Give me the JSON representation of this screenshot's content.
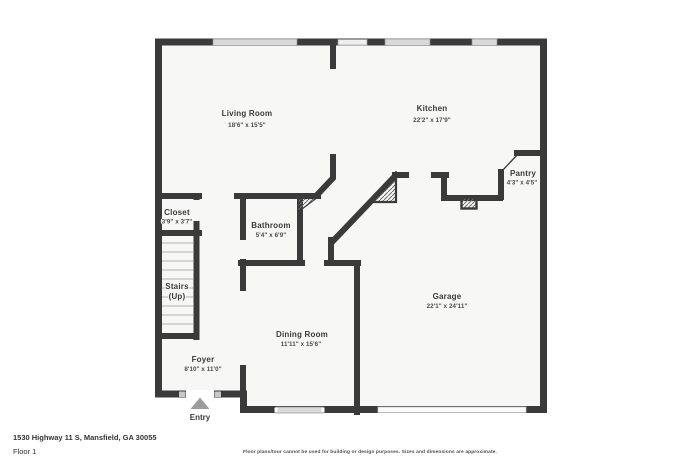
{
  "floorplan": {
    "rooms": [
      {
        "name": "Living Room",
        "dims": "18'6\" x 15'5\""
      },
      {
        "name": "Kitchen",
        "dims": "22'2\" x 17'9\""
      },
      {
        "name": "Pantry",
        "dims": "4'3\" x 4'5\""
      },
      {
        "name": "Closet",
        "dims": "3'9\" x 3'7\""
      },
      {
        "name": "Bathroom",
        "dims": "5'4\" x 6'9\""
      },
      {
        "name": "Dining Room",
        "dims": "11'11\" x 15'6\""
      },
      {
        "name": "Garage",
        "dims": "22'1\" x 24'11\""
      },
      {
        "name": "Foyer",
        "dims": "8'10\" x 11'0\""
      }
    ],
    "stairs_label": [
      "Stairs",
      "(Up)"
    ],
    "entry_label": "Entry",
    "footer": {
      "address": "1530 Highway 11 S, Mansfield, GA 30055",
      "floor": "Floor 1",
      "disclaimer": "Floor plans/tour cannot be used for building or design purposes. Sizes and dimensions are approximate."
    },
    "colors": {
      "wall": "#3a3a3a",
      "floor": "#f7f7f6",
      "window": "#d9d9d9",
      "entry_arrow": "#9c9c9c"
    }
  }
}
